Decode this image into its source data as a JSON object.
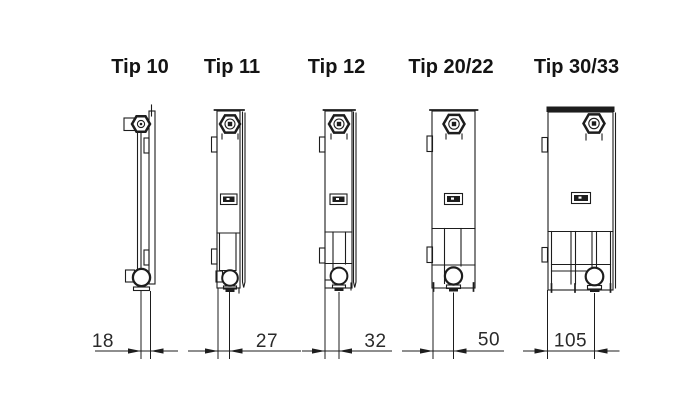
{
  "colors": {
    "background": "#ffffff",
    "line": "#1d1d1d",
    "text": "#141414"
  },
  "figures": [
    {
      "id": "tip-10",
      "label": "Tip 10",
      "dimension": "18"
    },
    {
      "id": "tip-11",
      "label": "Tip 11",
      "dimension": "27"
    },
    {
      "id": "tip-12",
      "label": "Tip 12",
      "dimension": "32"
    },
    {
      "id": "tip-20-22",
      "label": "Tip 20/22",
      "dimension": "50"
    },
    {
      "id": "tip-30-33",
      "label": "Tip 30/33",
      "dimension": "105"
    }
  ]
}
